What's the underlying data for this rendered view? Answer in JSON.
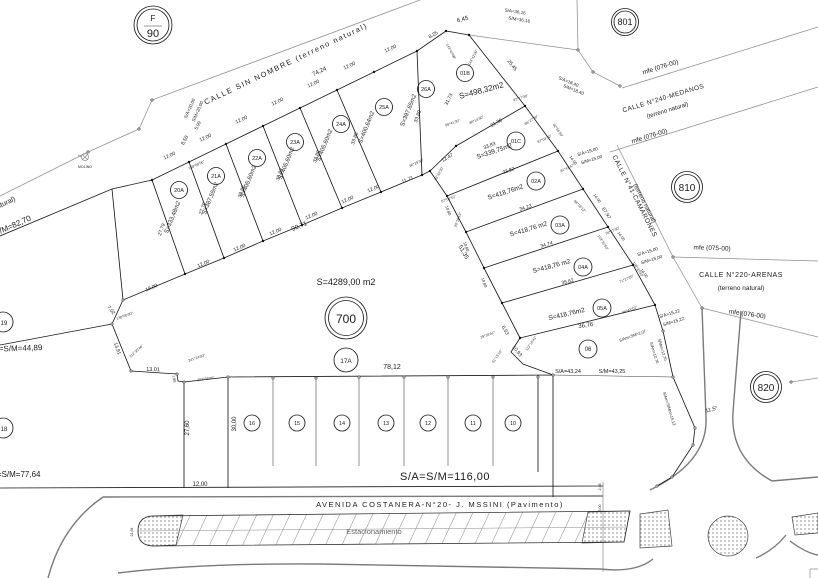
{
  "circles": {
    "sheet_letter": "F",
    "sheet_num": "90",
    "b801": "801",
    "b810": "810",
    "b820": "820",
    "p700": "700",
    "p17a": "17A",
    "p19": "19",
    "p18": "18",
    "p06": "06"
  },
  "streets": {
    "sin_nombre": "CALLE SIN NOMBRE (terreno natural)",
    "left_tail": "(terreno natural)",
    "medanos": "CALLE N°240-MEDANOS",
    "medanos_note": "(terreno natural)",
    "camarones": "CALLE N°41-CAMARONES",
    "camarones_note": "(terreno natural)",
    "arenas": "CALLE N°220-ARENAS",
    "arenas_note": "(terreno natural)",
    "avenida": "AVENIDA COSTANERA-N°20- J. MSSINI (Pavimento)",
    "estacionamiento": "Estacionamiento",
    "mfe1": "mfe (076-00)",
    "mfe2": "mfe (076-00)",
    "mfe3": "mfe (075-00)",
    "mfe4": "mfe (076-00)",
    "molino": "MOLINO"
  },
  "fan_lots": [
    {
      "id": "20A",
      "area": "S=333,48m2"
    },
    {
      "id": "21A",
      "area": "S=387,55m2"
    },
    {
      "id": "22A",
      "area": "S=405,60m2"
    },
    {
      "id": "23A",
      "area": "S=405,60m2"
    },
    {
      "id": "24A",
      "area": "S=405,60m2"
    },
    {
      "id": "25A",
      "area": "S=400,64m2"
    },
    {
      "id": "26A",
      "area": "S=397,65m2"
    },
    {
      "id": "01B",
      "area": "S=498,32m2"
    }
  ],
  "stack_lots": [
    {
      "id": "01C",
      "area": "S=339,75m2"
    },
    {
      "id": "02A",
      "area": "S=418,76m2"
    },
    {
      "id": "03A",
      "area": "S=418,76 m2"
    },
    {
      "id": "04A",
      "area": "S=418,76 m2"
    },
    {
      "id": "05A",
      "area": "S=418,76m2"
    }
  ],
  "row_lots": [
    "16",
    "15",
    "14",
    "13",
    "12",
    "11",
    "10"
  ],
  "big_area": "S=4289,00 m2",
  "refs": {
    "r8270": "S/A=S/M=82,70",
    "r4489": "S/A=S/M=44,89",
    "r7764": "S/A=S/M=77,64",
    "r116": "S/A=S/M=116,00",
    "r4324a": "S/A=43,24",
    "r4324b": "S/M=43,25",
    "r2000a": "S/A=20,00",
    "r2000b": "S/M=20,00",
    "r3616a": "S/A=36,16",
    "r3616b": "S/M=36,16",
    "r1840a": "S/A=18,40",
    "r1840b": "S/M=18,40",
    "r1500a1": "S/A=15,00",
    "r1500a2": "S/M=15,00",
    "r1500b1": "S/A=15,00",
    "r1500b2": "S/M=15,00",
    "r1522a": "S/A=15,22",
    "r1522b": "S/M=15,22",
    "r207": "S/Am=SM=2,07",
    "r1270a": "S/Am=12,70",
    "r1270b": "S/Mm=12,70",
    "r1513": "S/Am=S/Mm=15,13",
    "r115": "11,5°"
  },
  "dims": [
    "12,00",
    "12,00",
    "12,00",
    "12,00",
    "12,00",
    "12,00",
    "12,00",
    "74,24",
    "8,25",
    "6,45",
    "8,50",
    "5,99",
    "12,00",
    "12,00",
    "12,00",
    "12,00",
    "12,00",
    "12,00",
    "11,71",
    "90,71",
    "12,47",
    "21,36",
    "33,83",
    "27,79",
    "27,79",
    "33,80",
    "33,80",
    "33,80",
    "33,80",
    "33,80",
    "31,73",
    "25,45",
    "19,00",
    "7,02",
    "13,91",
    "13,01",
    "1,89",
    "51,35",
    "6,53",
    "10,93",
    "33,82",
    "34,13",
    "34,74",
    "35,62",
    "36,76",
    "14,00",
    "14,00",
    "14,00",
    "14,00",
    "10,80",
    "10,80",
    "10,80",
    "67,97",
    "78,12",
    "30,00",
    "27,60",
    "12,00",
    "2,48",
    "5,00",
    "21,84"
  ],
  "angles": [
    "138°00'00\"",
    "112°35'44\"",
    "241°24'00\"",
    "202°36'00\"",
    "138°00'00\"",
    "143°42'00\"",
    "143°42'00\"",
    "92°17'30\"",
    "86°27'30\"",
    "89°41'30\"",
    "86°14'30\"",
    "90°29'30\"",
    "93°32'30\"",
    "87°04'10\"",
    "92°55'50\"",
    "87°04'10\"",
    "81°41'47\"",
    "98°18'13\"",
    "103°32'50\"",
    "76°27'30\"",
    "71°27'20\"",
    "108°32'40\"",
    "66°43'19\"",
    "113°16'41\"",
    "29°18'41\"",
    "61°15'16\"",
    "96°18'13\""
  ]
}
